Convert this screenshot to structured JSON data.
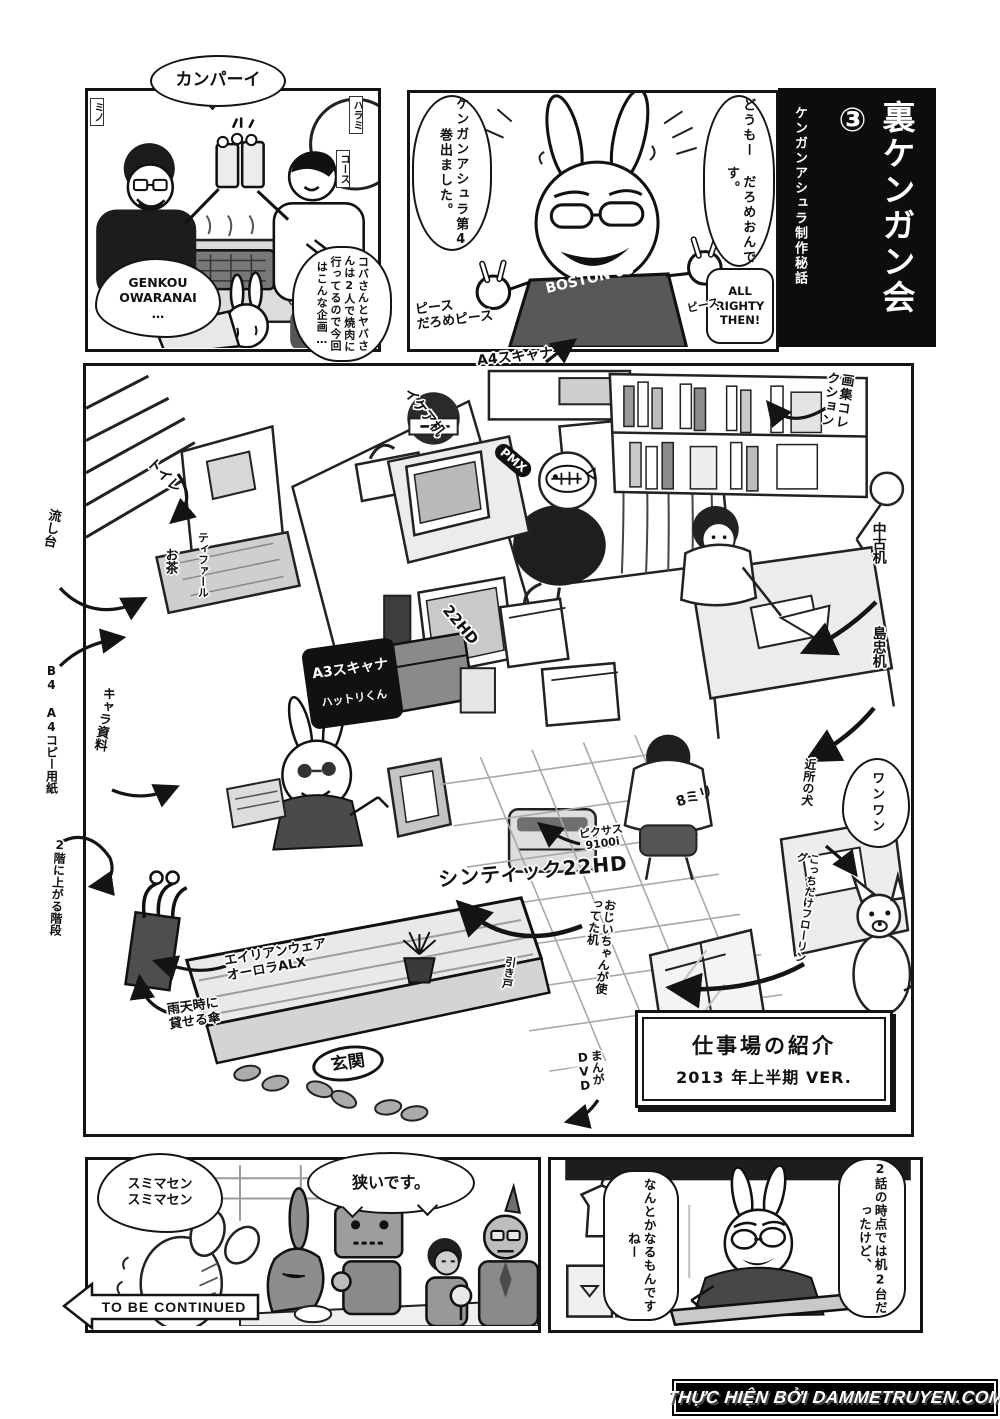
{
  "page": {
    "watermark": "THỰC HIỆN BỞI DAMMETRUYEN.COM"
  },
  "title_block": {
    "main": "裏ケンガン会③",
    "subtitle": "ケンガンアシュラ制作秘話"
  },
  "panel_yakiniku": {
    "shout": "カンパーイ",
    "genkou_bubble": "GENKOU\nOWARANAI\n…",
    "koba_bubble": "コバさんとヤバさんは2人で焼肉に行ってるので今回はこんな企画…",
    "sign_mino": "ミノ",
    "sign_harami": "ハラミ",
    "sign_course": "コース"
  },
  "panel_intro": {
    "greeting_bubble": "どうもー だろめおんです。",
    "book_bubble": "ケンガンアシュラ第4巻出ました。",
    "allright_bubble": "ALL RIGHTY THEN!",
    "peace_note": "ピース\nだろめピース",
    "peace_note_right": "ピース",
    "shirt": "BOSTON 03"
  },
  "workspace": {
    "sign_line1": "仕事場の紹介",
    "sign_line2": "2013 年上半期 VER.",
    "labels": {
      "a4_scanner": "A4スキャナ",
      "ikea_desk": "イケア机",
      "art_books": "画集コレクション",
      "toilet": "トイレ",
      "sink": "流し台",
      "tefal": "ティファール",
      "tea": "お茶",
      "used_desk": "中古机",
      "shimachu_desk": "島忠机",
      "copy_paper": "B4 A4コピー用紙",
      "chara_docs": "キャラ資料",
      "a3_scanner": "A3スキャナ",
      "a3_scanner_sub": "ハットリくん",
      "monitor_22hd": "22HD",
      "pixus": "ピクサス\n9100i",
      "cintiq": "シンティック22HD",
      "grandpa_desk": "おじいちゃんが使ってた机",
      "sliding_door": "引き戸",
      "neighbor_dog": "近所の犬",
      "flooring": "こっちだけフローリング",
      "woof": "ワンワン",
      "eight_mm": "8ミリ",
      "alienware": "エイリアンウェア\nオーロラALX",
      "umbrella": "雨天時に\n貸せる傘",
      "entrance": "玄関",
      "manga_dvd": "まんがDVD",
      "stairs": "2階に上がる階段",
      "pmx": "PMX"
    }
  },
  "panel_cramped": {
    "sorry_bubble": "スミマセン\nスミマセン",
    "narrow_bubble": "狭いです。",
    "to_be_continued": "TO BE CONTINUED"
  },
  "panel_outro": {
    "desk_bubble": "2話の時点では机2台だったけど、",
    "somehow_bubble": "なんとかなるもんですねー"
  }
}
